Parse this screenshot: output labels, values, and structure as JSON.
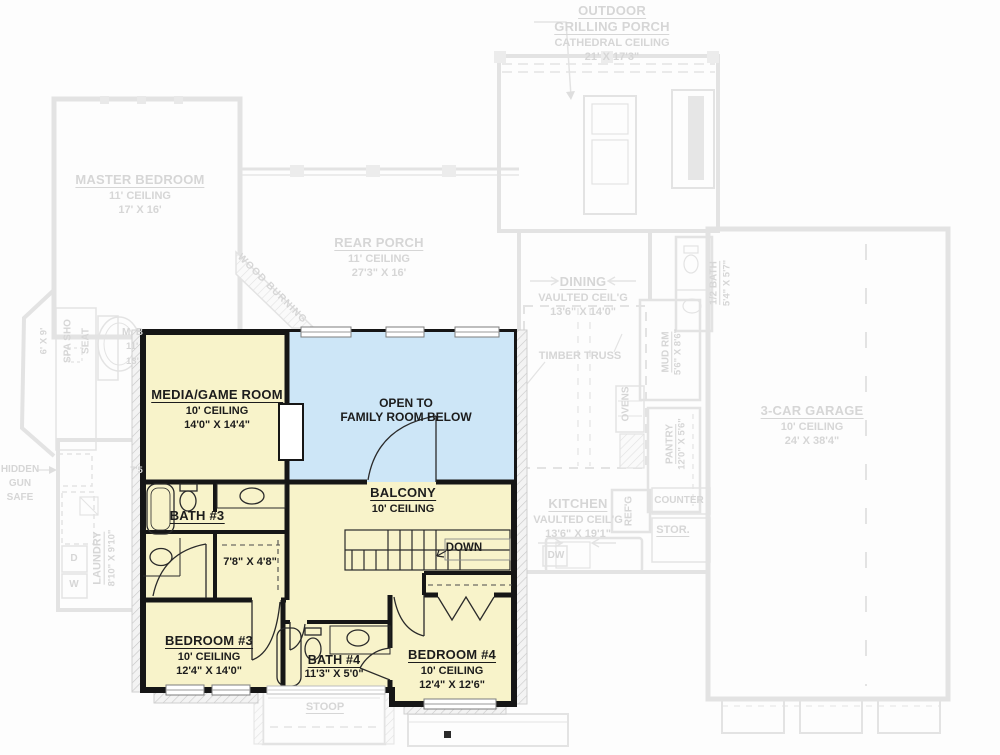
{
  "colors": {
    "highlight": "#f8f3ca",
    "open_below": "#cde6f7",
    "wall": "#161616",
    "faded_line": "#e3e3e3",
    "faded_text": "#d6d6d6"
  },
  "first_floor": {
    "grilling_porch": {
      "name1": "OUTDOOR",
      "name2": "GRILLING PORCH",
      "ceiling": "CATHEDRAL CEILING",
      "dims": "21' X 17'3\""
    },
    "master_bedroom": {
      "name": "MASTER BEDROOM",
      "ceiling": "11' CEILING",
      "dims": "17' X 16'"
    },
    "rear_porch": {
      "name": "REAR PORCH",
      "ceiling": "11' CEILING",
      "dims": "27'3\" X 16'"
    },
    "fireplace": {
      "label": "WOOD BURNING"
    },
    "dining": {
      "name": "DINING",
      "ceiling": "VAULTED CEIL'G",
      "dims": "13'6\" X 14'0\""
    },
    "timber_truss": {
      "label": "TIMBER TRUSS"
    },
    "half_bath": {
      "name": "1/2 BATH",
      "dims": "5'4\" X 5'7\""
    },
    "mud_room": {
      "name": "MUD RM",
      "dims": "5'6\" X 8'6\""
    },
    "ovens": {
      "label": "OVENS"
    },
    "pantry": {
      "name": "PANTRY",
      "dims": "12'0\" X 5'6\""
    },
    "garage": {
      "name": "3-CAR GARAGE",
      "ceiling": "10' CEILING",
      "dims": "24' X 38'4\""
    },
    "kitchen": {
      "name": "KITCHEN",
      "ceiling": "VAULTED CEIL'G",
      "dims": "13'6\" X 19'1\""
    },
    "refrigerator": {
      "label": "REF'G"
    },
    "counter": {
      "label": "COUNTER"
    },
    "storage": {
      "label": "STOR."
    },
    "dishwasher": {
      "label": "DW"
    },
    "gun_safe": {
      "line1": "HIDDEN",
      "line2": "GUN",
      "line3": "SAFE"
    },
    "spa_shower": {
      "name": "SPA SHO",
      "dims": "6' X 9'"
    },
    "seat": {
      "label": "SEAT"
    },
    "master_bath_partial": {
      "line1": "M. B",
      "line2": "11'",
      "line3": "13'"
    },
    "laundry": {
      "name": "LAUNDRY",
      "dims": "8'10\" X 9'10\""
    },
    "dryer": {
      "label": "D"
    },
    "washer": {
      "label": "W"
    },
    "dim_partial": {
      "label": "7'5"
    },
    "stoop": {
      "name": "STOOP"
    }
  },
  "second_floor": {
    "media_game_room": {
      "name": "MEDIA/GAME ROOM",
      "ceiling": "10' CEILING",
      "dims": "14'0\" X 14'4\""
    },
    "open_to_below": {
      "line1": "OPEN TO",
      "line2": "FAMILY ROOM BELOW"
    },
    "balcony": {
      "name": "BALCONY",
      "ceiling": "10' CEILING"
    },
    "stairs": {
      "label": "DOWN"
    },
    "bath_3": {
      "name": "BATH #3"
    },
    "closet_3": {
      "dims": "7'8\" X 4'8\""
    },
    "bedroom_3": {
      "name": "BEDROOM #3",
      "ceiling": "10' CEILING",
      "dims": "12'4\" X 14'0\""
    },
    "bath_4": {
      "name": "BATH #4",
      "dims": "11'3\" X 5'0\""
    },
    "bedroom_4": {
      "name": "BEDROOM #4",
      "ceiling": "10' CEILING",
      "dims": "12'4\" X 12'6\""
    }
  }
}
